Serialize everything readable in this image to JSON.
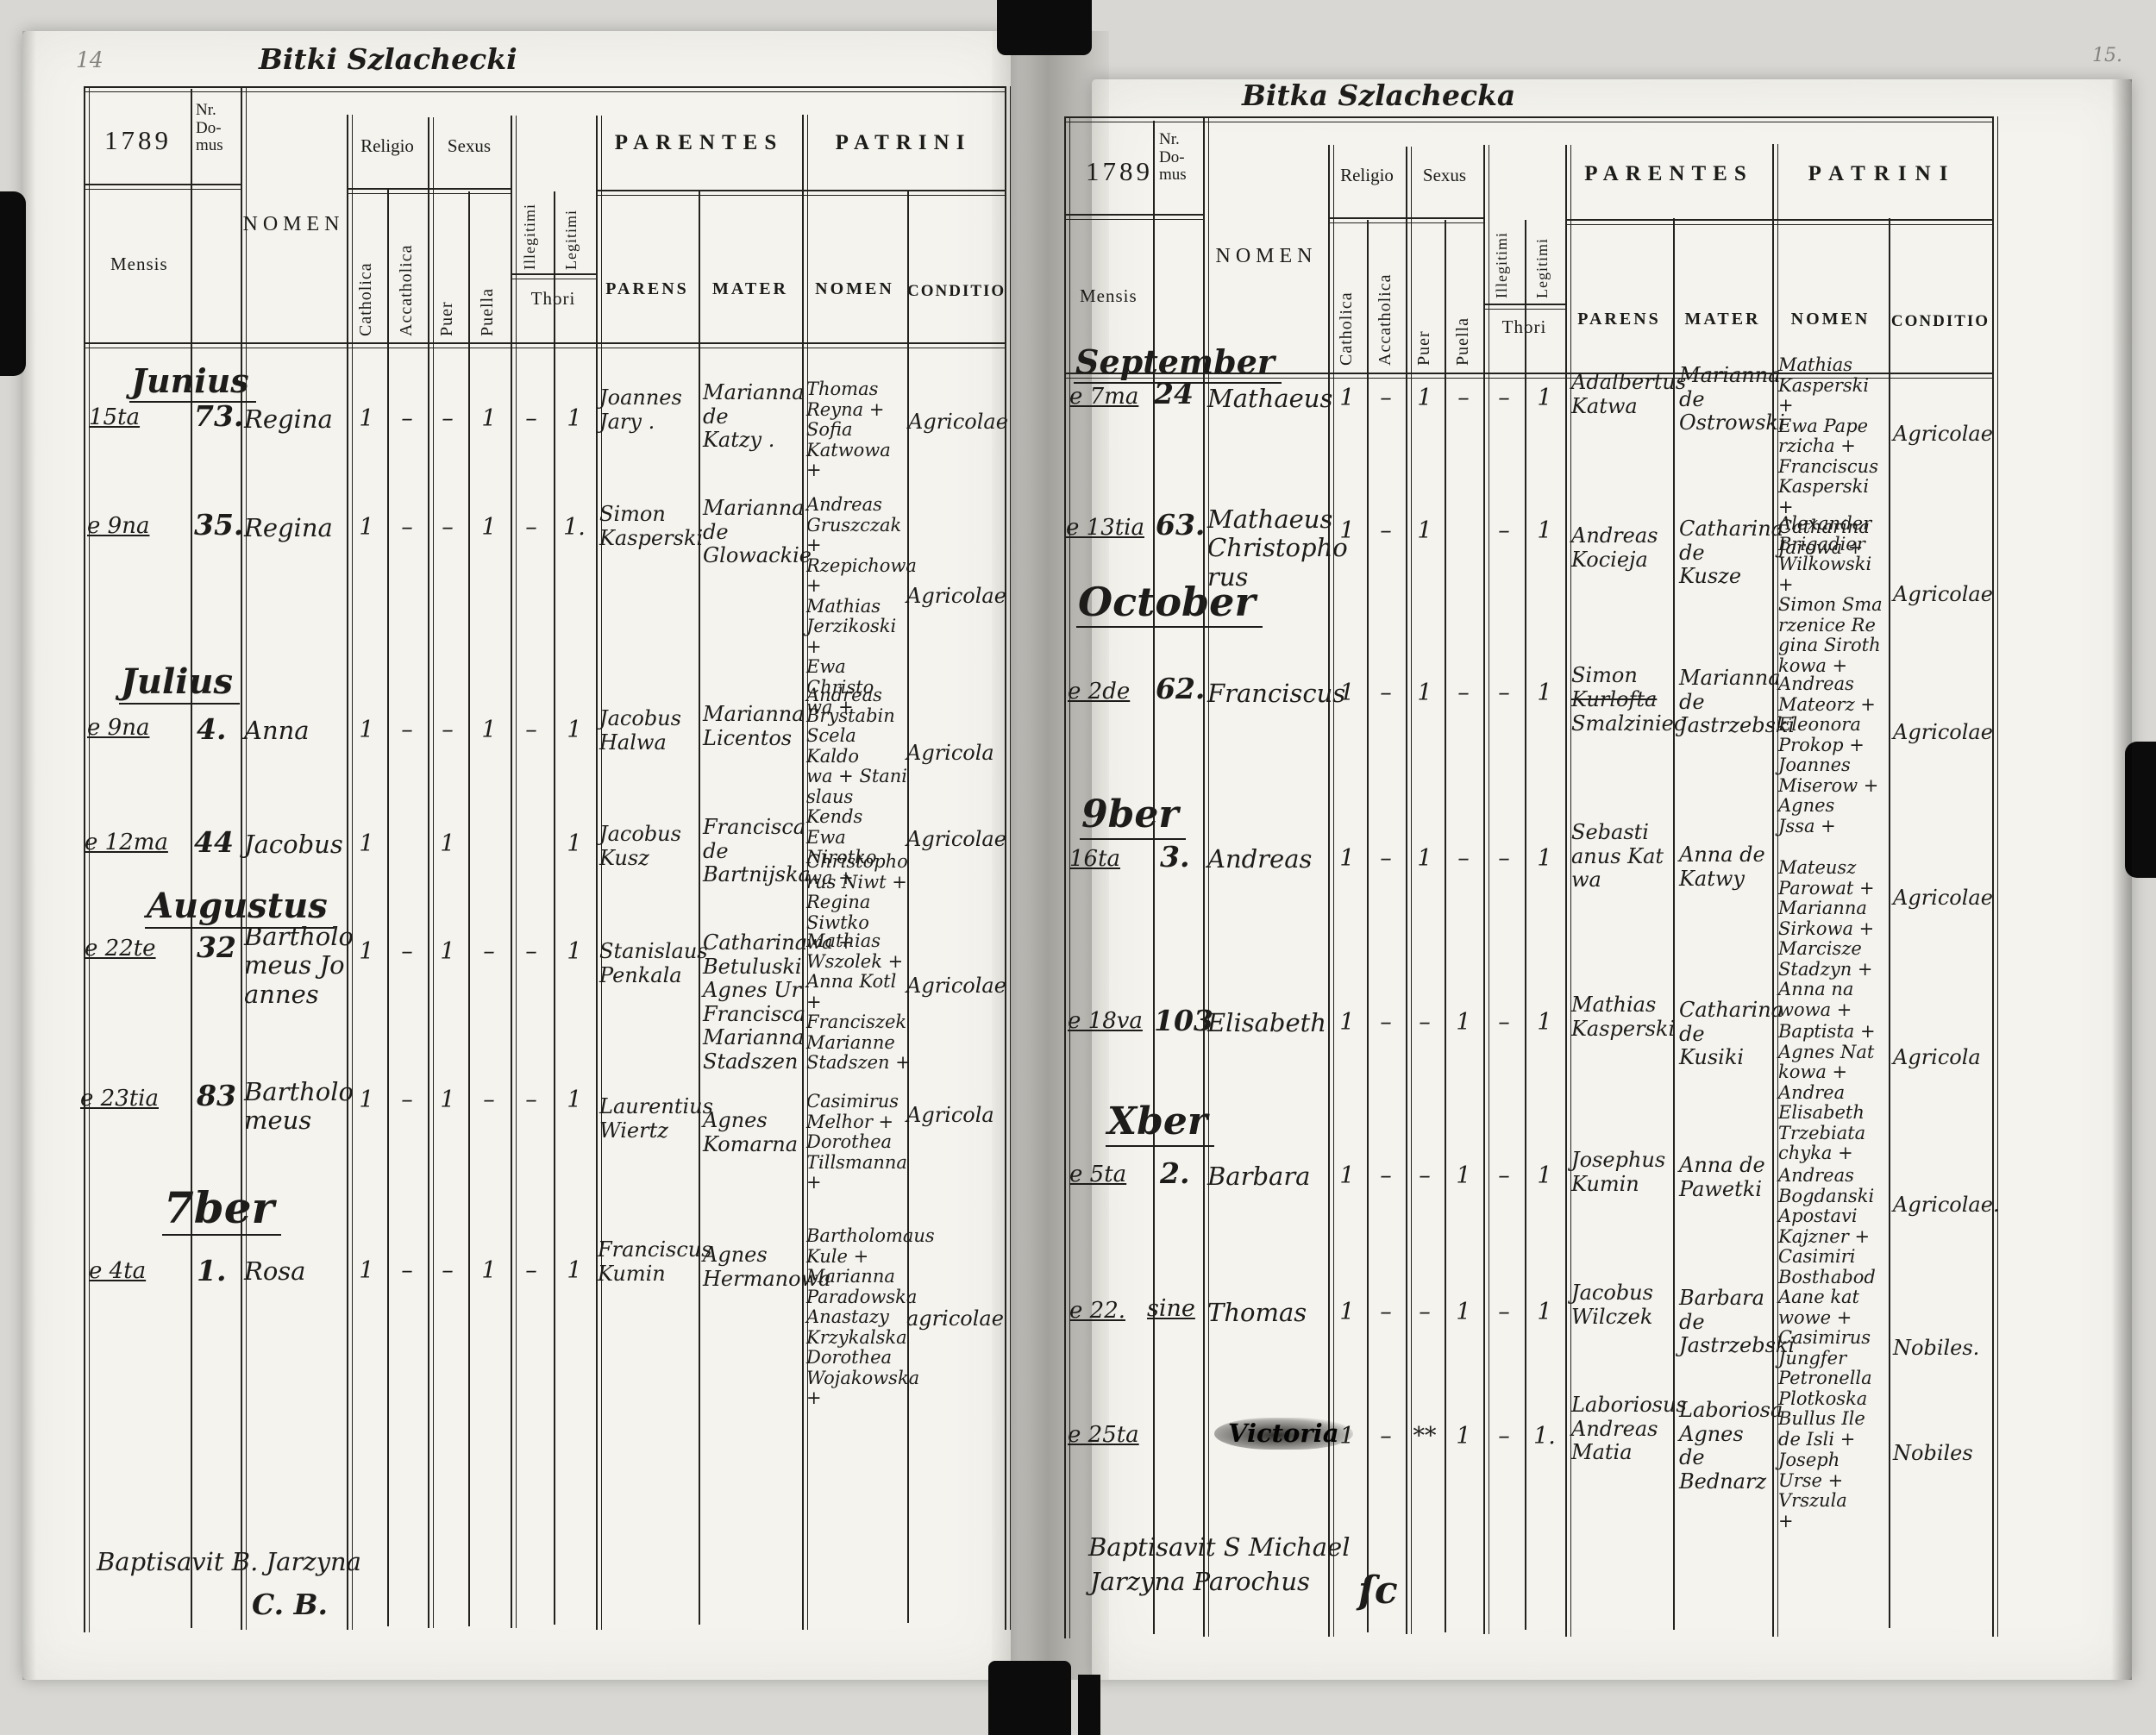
{
  "labels": {
    "year": "1789",
    "nr_domus": "Nr.\nDo-\nmus",
    "mensis": "Mensis",
    "nomen": "NOMEN",
    "religio": "Religio",
    "sexus": "Sexus",
    "catholica": "Catholica",
    "accatholica": "Accatholica",
    "puer": "Puer",
    "puella": "Puella",
    "illegitimi": "Illegitimi",
    "legitimi": "Legitimi",
    "thori": "Thori",
    "parentes": "PARENTES",
    "patrini": "PATRINI",
    "parens": "PARENS",
    "mater": "MATER",
    "patrini_nomen": "NOMEN",
    "conditio": "CONDITIO"
  },
  "left": {
    "page_number": "14",
    "title": "Bitki Szlachecki",
    "months": [
      "Junius",
      "Julius",
      "Augustus",
      "7ber"
    ],
    "entries": [
      {
        "date": "15ta",
        "nr": "73.",
        "name": "Regina",
        "m": [
          "1",
          "–",
          "–",
          "1",
          "–",
          "1"
        ],
        "parens": "Joannes\nJary .",
        "mater": "Marianna\nde\nKatzy .",
        "patrini": "Thomas\nReyna +\nSofia\nKatwowa\n+",
        "conditio": "Agricolae"
      },
      {
        "date": "e 9na",
        "nr": "35.",
        "name": "Regina",
        "m": [
          "1",
          "–",
          "–",
          "1",
          "–",
          "1."
        ],
        "parens": "Simon\nKasperski",
        "mater": "Marianna\nde\nGlowackie",
        "patrini": "Andreas\nGruszczak +\nRzepichowa +\nMathias\nJerzikoski +\nEwa Christo\nwa +",
        "conditio": "Agricolae"
      },
      {
        "date": "e 9na",
        "nr": "4.",
        "name": "Anna",
        "m": [
          "1",
          "–",
          "–",
          "1",
          "–",
          "1"
        ],
        "parens": "Jacobus\nHalwa",
        "mater": "Marianna\nLicentos",
        "patrini": "Andreas\nBrystabin\nScela Kaldo\nwa + Stani\nslaus Kends\nEwa Nirotko\nwa +",
        "conditio": "Agricola"
      },
      {
        "date": "e 12ma",
        "nr": "44",
        "name": "Jacobus",
        "m": [
          "1",
          "",
          "1",
          "",
          "",
          "1"
        ],
        "parens": "Jacobus\nKusz",
        "mater": "Francisca\nde\nBartnijska",
        "patrini": "Christopho\nrus Niwt +\nRegina Siwtko\nwa +",
        "conditio": "Agricolae"
      },
      {
        "date": "e 22te",
        "nr": "32",
        "name": "Bartholo\nmeus Jo\nannes",
        "m": [
          "1",
          "–",
          "1",
          "–",
          "–",
          "1"
        ],
        "parens": "Stanislaus\nPenkala",
        "mater": "Catharina\nBetuluski\nAgnes Ur\nFrancisca\nMarianna\nStadszen",
        "patrini": "Mathias\nWszolek +\nAnna Kotl +\nFranciszek\nMarianne\nStadszen +",
        "conditio": "Agricolae"
      },
      {
        "date": "e 23tia",
        "nr": "83",
        "name": "Bartholo\nmeus",
        "m": [
          "1",
          "–",
          "1",
          "–",
          "–",
          "1"
        ],
        "parens": "Laurentius\nWiertz",
        "mater": "Agnes\nKomarna",
        "patrini": "Casimirus\nMelhor +\nDorothea\nTillsmanna\n+",
        "conditio": "Agricola"
      },
      {
        "date": "e 4ta",
        "nr": "1.",
        "name": "Rosa",
        "m": [
          "1",
          "–",
          "–",
          "1",
          "–",
          "1"
        ],
        "parens": "Franciscus\nKumin",
        "mater": "Agnes\nHermanowa",
        "patrini": "Bartholomaus\nKule +\nMarianna\nParadowska\nAnastazy\nKrzykalska\nDorothea\nWojakowska\n+",
        "conditio": "agricolae"
      }
    ],
    "footer": {
      "line1": "Baptisavit B. Jarzyna",
      "sig": "C. B."
    }
  },
  "right": {
    "page_number": "15.",
    "title": "Bitka Szlachecka",
    "months": [
      "September",
      "October",
      "9ber",
      "Xber"
    ],
    "entries": [
      {
        "date": "e 7ma",
        "nr": "24",
        "name": "Mathaeus",
        "m": [
          "1",
          "–",
          "1",
          "–",
          "–",
          "1"
        ],
        "parens": "Adalbertus\nKatwa",
        "mater": "Marianna\nde\nOstrowski",
        "patrini": "Mathias\nKasperski +\nEwa Pape\nrzicha +\nFranciscus\nKasperski +\nCatharina\nJarowa +",
        "conditio": "Agricolae"
      },
      {
        "date": "e 13tia",
        "nr": "63.",
        "name": "Mathaeus\nChristopho\nrus",
        "m": [
          "1",
          "–",
          "1",
          "",
          "–",
          "1"
        ],
        "parens": "Andreas\nKocieja",
        "mater": "Catharina\nde\nKusze",
        "patrini": "Alexander\nBrigadier\nWilkowski +\nSimon Sma\nrzenice Re\ngina Siroth\nkowa +",
        "conditio": "Agricolae"
      },
      {
        "date": "e 2de",
        "nr": "62.",
        "name": "Franciscus",
        "m": [
          "1",
          "–",
          "1",
          "–",
          "–",
          "1"
        ],
        "parens_1": "Simon",
        "parens_strike": "Kurlofta",
        "parens_2": "Smalziniec",
        "mater": "Marianna\nde\nJastrzebski",
        "patrini": "Andreas\nMateorz +\nEleonora\nProkop +\nJoannes\nMiserow +\nAgnes\nJssa +",
        "conditio": "Agricolae"
      },
      {
        "date": "16ta",
        "nr": "3.",
        "name": "Andreas",
        "m": [
          "1",
          "–",
          "1",
          "–",
          "–",
          "1"
        ],
        "parens": "Sebasti\nanus Kat\nwa",
        "mater": "Anna de\nKatwy",
        "patrini": "Mateusz\nParowat +\nMarianna\nSirkowa +\nMarcisze\nStadzyn +\nAnna na\nwowa +",
        "conditio": "Agricolae"
      },
      {
        "date": "e 18va",
        "nr": "103",
        "name": "Elisabeth",
        "m": [
          "1",
          "–",
          "–",
          "1",
          "–",
          "1"
        ],
        "parens": "Mathias\nKasperski",
        "mater": "Catharina\nde Kusiki",
        "patrini": "Baptista +\nAgnes Nat\nkowa +\nAndrea\nElisabeth\nTrzebiata\nchyka +",
        "conditio": "Agricola"
      },
      {
        "date": "e 5ta",
        "nr": "2.",
        "name": "Barbara",
        "m": [
          "1",
          "–",
          "–",
          "1",
          "–",
          "1"
        ],
        "parens": "Josephus\nKumin",
        "mater": "Anna de\nPawetki",
        "patrini": "Andreas\nBogdanski\nApostavi\nKajzner +\nCasimiri\nBosthabod\nAane kat\nwowe +",
        "conditio": "Agricolae."
      },
      {
        "date": "e 22.",
        "nr": "sine",
        "name": "Thomas",
        "m": [
          "1",
          "–",
          "–",
          "1",
          "–",
          "1"
        ],
        "parens": "Jacobus\nWilczek",
        "mater": "Barbara\nde\nJastrzebski",
        "patrini": "Casimirus\nJungfer\nPetronella\nPlotkoska\nBullus Ile\nde Isli +",
        "conditio": "Nobiles."
      },
      {
        "date": "e 25ta",
        "nr": "",
        "name": "Victoria",
        "m": [
          "1",
          "–",
          "**",
          "1",
          "–",
          "1."
        ],
        "parens": "Laboriosus\nAndreas\nMatia",
        "mater": "Laboriosa\nAgnes\nde\nBednarz",
        "patrini": "Joseph\nUrse +\nVrszula\n+",
        "conditio": "Nobiles"
      }
    ],
    "footer": {
      "line1": "Baptisavit S Michael",
      "line2": "Jarzyna Parochus",
      "sig": "ſc"
    }
  }
}
